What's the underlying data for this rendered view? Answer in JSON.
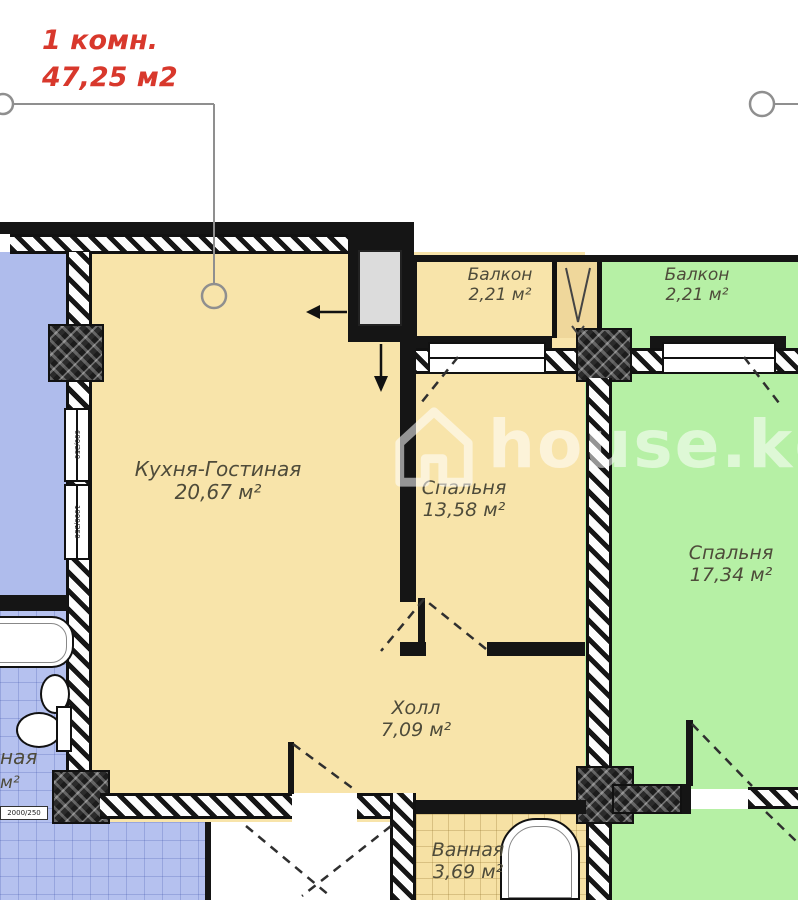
{
  "annotation": {
    "line1": "1 комн.",
    "line2": "47,25 м2"
  },
  "watermark": {
    "text": "house.kg"
  },
  "rooms": [
    {
      "id": "kitchen-living",
      "name": "Кухня-Гостиная",
      "area": "20,67 м²"
    },
    {
      "id": "bedroom-1",
      "name": "Спальня",
      "area": "13,58 м²"
    },
    {
      "id": "bedroom-2",
      "name": "Спальня",
      "area": "17,34 м²"
    },
    {
      "id": "hall",
      "name": "Холл",
      "area": "7,09 м²"
    },
    {
      "id": "bathroom",
      "name": "Ванная",
      "area": "3,69 м²"
    },
    {
      "id": "balcony-left",
      "name": "Балкон",
      "area": "2,21 м²"
    },
    {
      "id": "balcony-right",
      "name": "Балкон",
      "area": "2,21 м²"
    },
    {
      "id": "neighbor-bathroom-fragment",
      "name": "ная",
      "area": "м²"
    }
  ],
  "window_dims": {
    "a": "600/250",
    "b": "1000/250",
    "c": "2000/250"
  },
  "colors": {
    "apartment": "#F8E4AA",
    "neighbor_green": "#B6F0A5",
    "neighbor_blue": "#AFBCEC",
    "wall": "#151515",
    "annotation_red": "#D8382C",
    "label_text": "#4E4B3A",
    "watermark": "rgba(255,255,255,0.55)"
  }
}
